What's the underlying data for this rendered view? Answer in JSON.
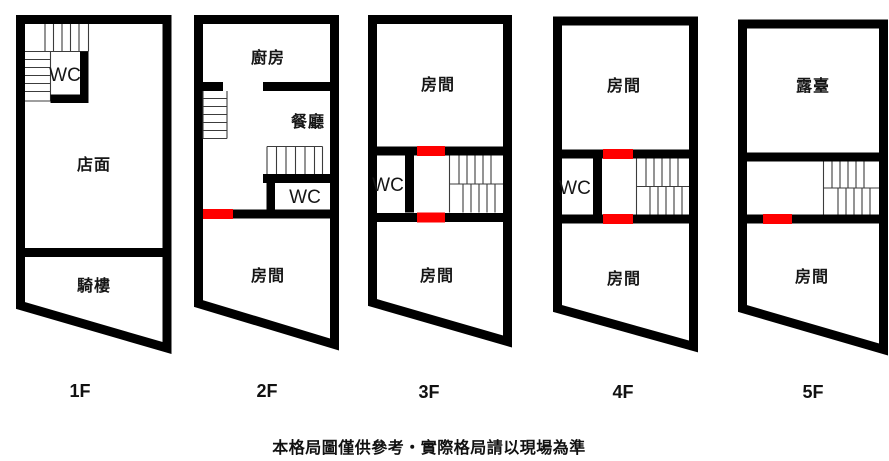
{
  "colors": {
    "wall": "#000000",
    "door_red": "#ff0000",
    "background": "#ffffff",
    "label": "#161616"
  },
  "disclaimer": "本格局圖僅供參考‧實際格局請以現場為準",
  "floors": [
    {
      "label": "1F",
      "rooms": {
        "wc": "WC",
        "main": "店面",
        "arcade": "騎樓"
      }
    },
    {
      "label": "2F",
      "rooms": {
        "kitchen": "廚房",
        "dining": "餐廳",
        "wc": "WC",
        "room": "房間"
      }
    },
    {
      "label": "3F",
      "rooms": {
        "room_top": "房間",
        "wc": "WC",
        "room_bottom": "房間"
      }
    },
    {
      "label": "4F",
      "rooms": {
        "room_top": "房間",
        "wc": "WC",
        "room_bottom": "房間"
      }
    },
    {
      "label": "5F",
      "rooms": {
        "terrace": "露臺",
        "room_bottom": "房間"
      }
    }
  ]
}
